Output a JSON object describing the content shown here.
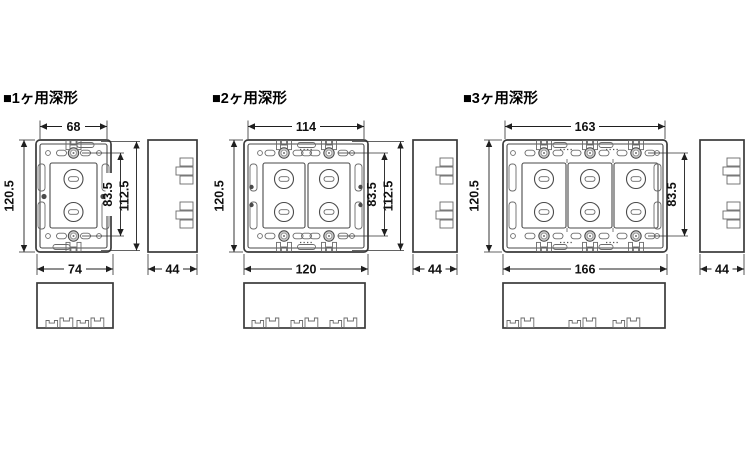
{
  "drawing": {
    "type": "technical-dimension-drawing",
    "colors": {
      "background": "#ffffff",
      "outline": "#3a3a3a",
      "detail_line": "#6a6a6a",
      "dimension": "#1f1f1f",
      "screw_fill": "#c9c9c9",
      "text": "#000000"
    }
  },
  "sections": [
    {
      "title": "■1ヶ用深形",
      "gangs": 1,
      "dims": {
        "body_width": "68",
        "flange_width": "74",
        "height": "120.5",
        "screw_pitch": "83.5",
        "tab_pitch": "112.5",
        "depth": "44"
      }
    },
    {
      "title": "■2ヶ用深形",
      "gangs": 2,
      "dims": {
        "body_width": "114",
        "flange_width": "120",
        "height": "120.5",
        "screw_pitch": "83.5",
        "tab_pitch": "112.5",
        "depth": "44"
      }
    },
    {
      "title": "■3ヶ用深形",
      "gangs": 3,
      "dims": {
        "body_width": "163",
        "flange_width": "166",
        "height": "120.5",
        "screw_pitch": "83.5",
        "depth": "44"
      }
    }
  ]
}
